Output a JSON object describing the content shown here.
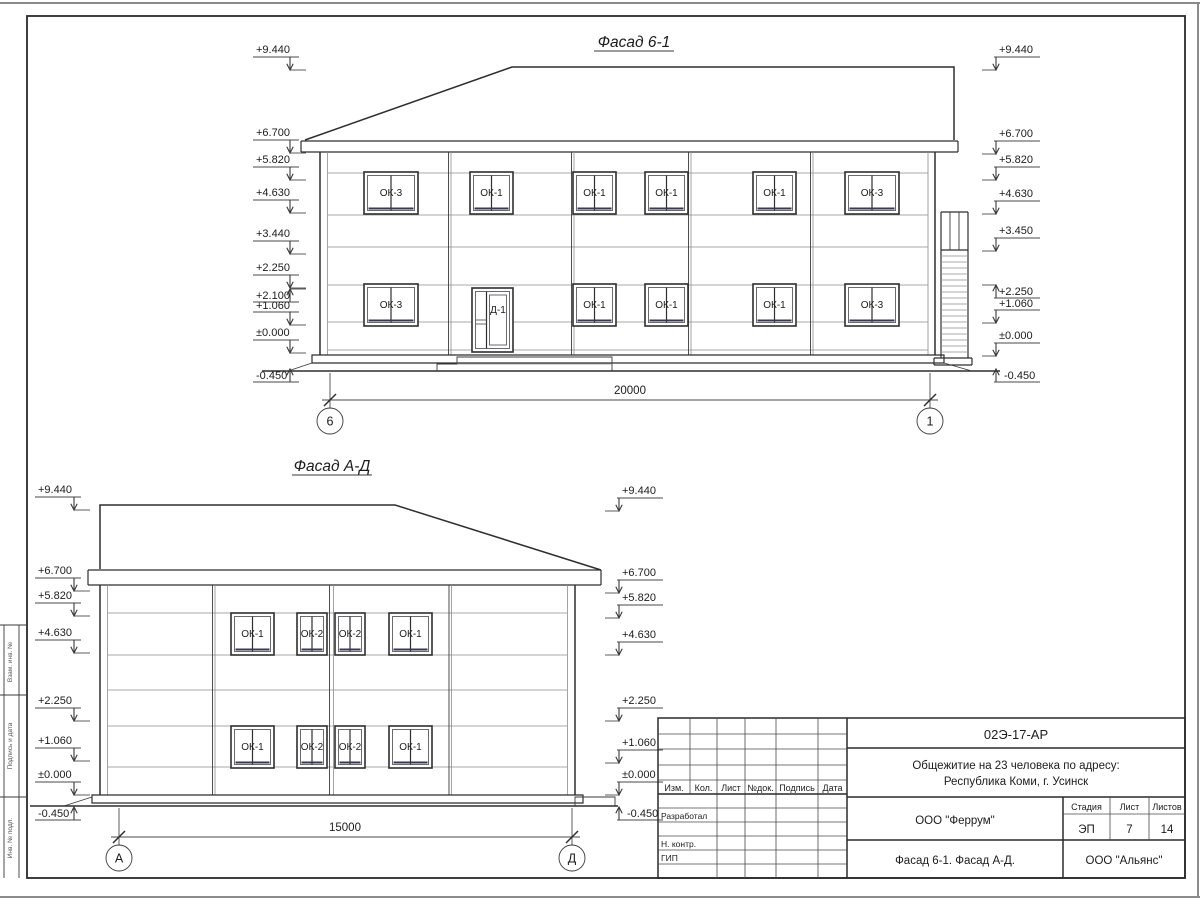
{
  "ink": "#2e2e2e",
  "facade1": {
    "title": "Фасад 6-1",
    "dimension": "20000",
    "axis_left": "6",
    "axis_right": "1",
    "door_label": "Д-1",
    "marks_left": [
      "+9.440",
      "+6.700",
      "+5.820",
      "+4.630",
      "+3.440",
      "+2.250",
      "+2.100",
      "+1.060",
      "±0.000",
      "-0.450"
    ],
    "marks_right": [
      "+9.440",
      "+6.700",
      "+5.820",
      "+4.630",
      "+3.450",
      "+2.250",
      "+1.060",
      "±0.000",
      "-0.450"
    ],
    "windows_upper": [
      "ОК-3",
      "ОК-1",
      "ОК-1",
      "ОК-1",
      "ОК-1",
      "ОК-3"
    ],
    "windows_lower": [
      "ОК-3",
      "ОК-1",
      "ОК-1",
      "ОК-1",
      "ОК-3"
    ]
  },
  "facade2": {
    "title": "Фасад А-Д",
    "dimension": "15000",
    "axis_left": "А",
    "axis_right": "Д",
    "marks_left": [
      "+9.440",
      "+6.700",
      "+5.820",
      "+4.630",
      "+2.250",
      "+1.060",
      "±0.000",
      "-0.450"
    ],
    "marks_right": [
      "+9.440",
      "+6.700",
      "+5.820",
      "+4.630",
      "+2.250",
      "+1.060",
      "±0.000",
      "-0.450"
    ],
    "windows_upper": [
      "ОК-1",
      "ОК-2",
      "ОК-2",
      "ОК-1"
    ],
    "windows_lower": [
      "ОК-1",
      "ОК-2",
      "ОК-2",
      "ОК-1"
    ]
  },
  "left_margin": {
    "labels": [
      "Взам. инв. №",
      "Подпись и дата",
      "Инв. № подл."
    ]
  },
  "title_block": {
    "doc_code": "02Э-17-АР",
    "project_line1": "Общежитие на 23 человека по адресу:",
    "project_line2": "Республика Коми, г. Усинск",
    "columns": [
      "Изм.",
      "Кол.",
      "Лист",
      "№док.",
      "Подпись",
      "Дата"
    ],
    "roles": [
      "Разработал",
      "Н. контр.",
      "ГИП"
    ],
    "org": "ООО \"Феррум\"",
    "stage_label": "Стадия",
    "sheet_label": "Лист",
    "sheets_label": "Листов",
    "stage": "ЭП",
    "sheet_no": "7",
    "sheets_total": "14",
    "sheet_title": "Фасад 6-1. Фасад А-Д.",
    "contractor": "ООО \"Альянс\""
  }
}
